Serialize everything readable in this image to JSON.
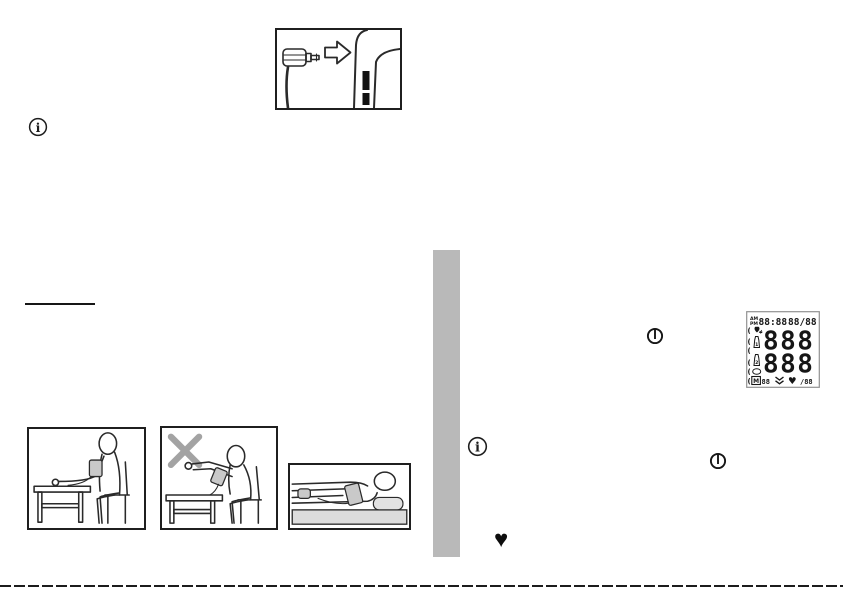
{
  "colors": {
    "divider_bar": "#b9b9b9",
    "line_art": "#2a2a2a",
    "wrong_cross": "#a3a3a3",
    "cuff_shade": "#c9c9c9",
    "lcd_border": "#919191",
    "footer_rule": "#1c1c1c"
  },
  "icons": {
    "info_glyph": "i",
    "heart_glyph": "♥"
  },
  "lcd": {
    "marker": "(",
    "am": "AM",
    "pm": "PM",
    "time": "88:88",
    "date": "88/88",
    "reading_top": "888",
    "reading_bottom": "888",
    "cuff1_label": "1",
    "cuff2_label": "2",
    "memory_label": "M",
    "memory_count": "88",
    "pulse_value": "/88"
  }
}
